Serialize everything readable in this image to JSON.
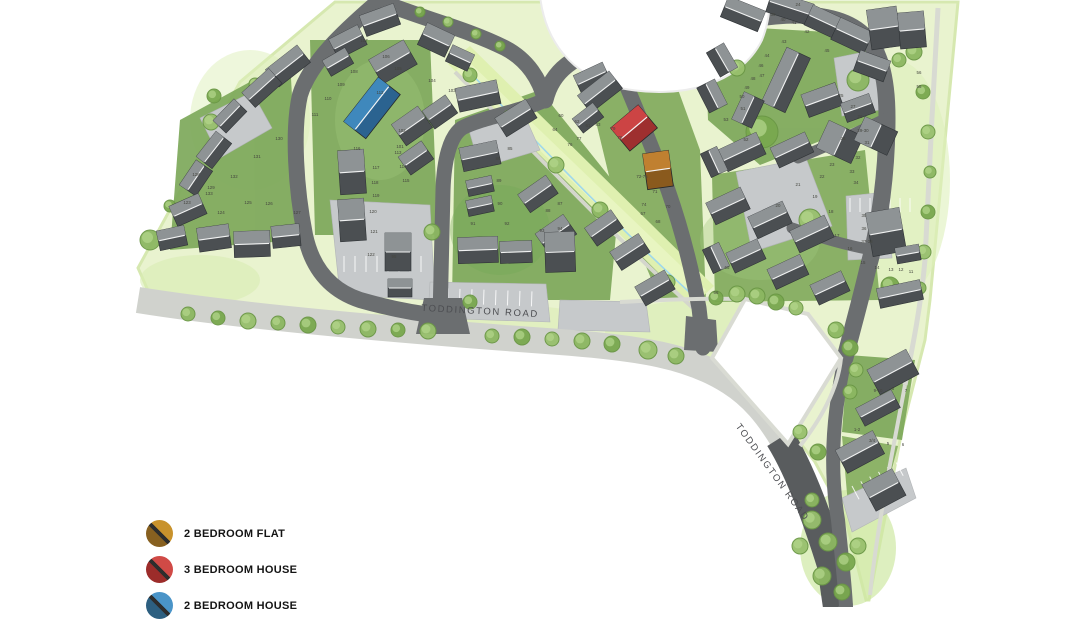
{
  "map": {
    "description": "Housing development site plan, watercolour style",
    "road_labels": [
      {
        "text": "TODDINGTON ROAD",
        "x": 480,
        "y": 314,
        "rotate": 3
      },
      {
        "text": "TODDINGTON ROAD",
        "x": 770,
        "y": 474,
        "rotate": 54
      }
    ],
    "colors": {
      "road_dark": "#6b6e70",
      "road_existing": "#d0d2cd",
      "garden_green": "#7da85a",
      "open_space": "#e9f3cf",
      "house_roof_dark": "#4b4f52",
      "house_roof_light": "#969a9c",
      "stream_blue": "#9fd8ec"
    },
    "highlighted_units": [
      {
        "type": "2 BEDROOM FLAT",
        "plots": "72-75",
        "color": "#c08030",
        "dark": "#8a5a1d",
        "x": 658,
        "y": 170,
        "w": 26,
        "h": 36,
        "rotate": -8
      },
      {
        "type": "3 BEDROOM HOUSE",
        "plots": "76-79",
        "color": "#cc4444",
        "dark": "#9e2f2f",
        "x": 634,
        "y": 128,
        "w": 36,
        "h": 30,
        "rotate": -40
      },
      {
        "type": "2 BEDROOM HOUSE",
        "plots": "113-115",
        "color": "#3f88bc",
        "dark": "#2b6390",
        "x": 372,
        "y": 108,
        "w": 56,
        "h": 28,
        "rotate": -52
      }
    ],
    "plot_labels": [
      {
        "n": "123",
        "x": 187,
        "y": 204
      },
      {
        "n": "124",
        "x": 221,
        "y": 214
      },
      {
        "n": "125",
        "x": 248,
        "y": 204
      },
      {
        "n": "126",
        "x": 269,
        "y": 205
      },
      {
        "n": "127",
        "x": 297,
        "y": 214
      },
      {
        "n": "128",
        "x": 196,
        "y": 176
      },
      {
        "n": "129",
        "x": 211,
        "y": 189
      },
      {
        "n": "130",
        "x": 279,
        "y": 140
      },
      {
        "n": "131",
        "x": 257,
        "y": 158
      },
      {
        "n": "132",
        "x": 234,
        "y": 178
      },
      {
        "n": "133",
        "x": 209,
        "y": 195
      },
      {
        "n": "101",
        "x": 400,
        "y": 148
      },
      {
        "n": "102",
        "x": 402,
        "y": 132
      },
      {
        "n": "103",
        "x": 452,
        "y": 92
      },
      {
        "n": "104",
        "x": 432,
        "y": 82
      },
      {
        "n": "105",
        "x": 398,
        "y": 70
      },
      {
        "n": "106",
        "x": 386,
        "y": 58
      },
      {
        "n": "107",
        "x": 364,
        "y": 42
      },
      {
        "n": "108",
        "x": 354,
        "y": 73
      },
      {
        "n": "109",
        "x": 341,
        "y": 86
      },
      {
        "n": "110",
        "x": 328,
        "y": 100
      },
      {
        "n": "111",
        "x": 315,
        "y": 116
      },
      {
        "n": "112",
        "x": 380,
        "y": 94
      },
      {
        "n": "113",
        "x": 398,
        "y": 154
      },
      {
        "n": "114",
        "x": 403,
        "y": 168
      },
      {
        "n": "115",
        "x": 406,
        "y": 182
      },
      {
        "n": "116",
        "x": 357,
        "y": 150
      },
      {
        "n": "117",
        "x": 376,
        "y": 169
      },
      {
        "n": "118",
        "x": 375,
        "y": 184
      },
      {
        "n": "119",
        "x": 376,
        "y": 197
      },
      {
        "n": "120",
        "x": 373,
        "y": 213
      },
      {
        "n": "121",
        "x": 374,
        "y": 233
      },
      {
        "n": "122",
        "x": 371,
        "y": 256
      },
      {
        "n": "60",
        "x": 561,
        "y": 117
      },
      {
        "n": "61",
        "x": 588,
        "y": 127
      },
      {
        "n": "62",
        "x": 577,
        "y": 123
      },
      {
        "n": "63",
        "x": 598,
        "y": 126
      },
      {
        "n": "64",
        "x": 555,
        "y": 131
      },
      {
        "n": "67",
        "x": 643,
        "y": 215
      },
      {
        "n": "68",
        "x": 658,
        "y": 223
      },
      {
        "n": "70",
        "x": 668,
        "y": 208
      },
      {
        "n": "71",
        "x": 655,
        "y": 193
      },
      {
        "n": "72-75",
        "x": 642,
        "y": 178
      },
      {
        "n": "74",
        "x": 644,
        "y": 206
      },
      {
        "n": "76",
        "x": 570,
        "y": 146
      },
      {
        "n": "77",
        "x": 579,
        "y": 140
      },
      {
        "n": "78",
        "x": 620,
        "y": 139
      },
      {
        "n": "79",
        "x": 613,
        "y": 130
      },
      {
        "n": "85",
        "x": 510,
        "y": 150
      },
      {
        "n": "86",
        "x": 498,
        "y": 160
      },
      {
        "n": "87",
        "x": 560,
        "y": 205
      },
      {
        "n": "88",
        "x": 548,
        "y": 212
      },
      {
        "n": "89",
        "x": 499,
        "y": 182
      },
      {
        "n": "90",
        "x": 500,
        "y": 205
      },
      {
        "n": "91",
        "x": 473,
        "y": 225
      },
      {
        "n": "92",
        "x": 507,
        "y": 225
      },
      {
        "n": "93",
        "x": 542,
        "y": 232
      },
      {
        "n": "94",
        "x": 560,
        "y": 230
      },
      {
        "n": "95",
        "x": 394,
        "y": 258
      },
      {
        "n": "11",
        "x": 911,
        "y": 273
      },
      {
        "n": "12",
        "x": 901,
        "y": 271
      },
      {
        "n": "13",
        "x": 891,
        "y": 271
      },
      {
        "n": "14",
        "x": 877,
        "y": 269
      },
      {
        "n": "15",
        "x": 863,
        "y": 264
      },
      {
        "n": "16",
        "x": 850,
        "y": 250
      },
      {
        "n": "17",
        "x": 837,
        "y": 237
      },
      {
        "n": "18",
        "x": 831,
        "y": 213
      },
      {
        "n": "19",
        "x": 815,
        "y": 198
      },
      {
        "n": "20",
        "x": 778,
        "y": 207
      },
      {
        "n": "21",
        "x": 798,
        "y": 186
      },
      {
        "n": "22",
        "x": 822,
        "y": 178
      },
      {
        "n": "23",
        "x": 832,
        "y": 166
      },
      {
        "n": "24",
        "x": 798,
        "y": 6
      },
      {
        "n": "25",
        "x": 841,
        "y": 97
      },
      {
        "n": "26",
        "x": 843,
        "y": 140
      },
      {
        "n": "27",
        "x": 853,
        "y": 108
      },
      {
        "n": "28",
        "x": 860,
        "y": 118
      },
      {
        "n": "29-30",
        "x": 863,
        "y": 132
      },
      {
        "n": "31",
        "x": 867,
        "y": 144
      },
      {
        "n": "32",
        "x": 858,
        "y": 159
      },
      {
        "n": "33",
        "x": 852,
        "y": 173
      },
      {
        "n": "34",
        "x": 856,
        "y": 184
      },
      {
        "n": "35",
        "x": 864,
        "y": 217
      },
      {
        "n": "36",
        "x": 864,
        "y": 230
      },
      {
        "n": "37-38",
        "x": 867,
        "y": 243
      },
      {
        "n": "39",
        "x": 773,
        "y": 16
      },
      {
        "n": "40",
        "x": 783,
        "y": 21
      },
      {
        "n": "41",
        "x": 794,
        "y": 24
      },
      {
        "n": "42",
        "x": 807,
        "y": 33
      },
      {
        "n": "43",
        "x": 784,
        "y": 43
      },
      {
        "n": "44",
        "x": 767,
        "y": 57
      },
      {
        "n": "45",
        "x": 827,
        "y": 52
      },
      {
        "n": "46",
        "x": 761,
        "y": 67
      },
      {
        "n": "47",
        "x": 762,
        "y": 77
      },
      {
        "n": "48",
        "x": 753,
        "y": 80
      },
      {
        "n": "49",
        "x": 747,
        "y": 89
      },
      {
        "n": "50",
        "x": 742,
        "y": 98
      },
      {
        "n": "51",
        "x": 743,
        "y": 110
      },
      {
        "n": "52",
        "x": 746,
        "y": 141
      },
      {
        "n": "53",
        "x": 726,
        "y": 121
      },
      {
        "n": "55",
        "x": 919,
        "y": 88
      },
      {
        "n": "56",
        "x": 919,
        "y": 74
      },
      {
        "n": "65",
        "x": 727,
        "y": 269
      },
      {
        "n": "66",
        "x": 716,
        "y": 294
      },
      {
        "n": "1-2",
        "x": 857,
        "y": 431
      },
      {
        "n": "3/4",
        "x": 872,
        "y": 442
      },
      {
        "n": "5",
        "x": 888,
        "y": 445
      },
      {
        "n": "6",
        "x": 903,
        "y": 446
      },
      {
        "n": "7",
        "x": 906,
        "y": 392
      },
      {
        "n": "8",
        "x": 893,
        "y": 390
      },
      {
        "n": "9-10",
        "x": 878,
        "y": 392
      }
    ]
  },
  "legend": {
    "items": [
      {
        "label": "2 BEDROOM FLAT",
        "color": "#c8922c",
        "color_dark": "#876020"
      },
      {
        "label": "3 BEDROOM HOUSE",
        "color": "#d04a46",
        "color_dark": "#9c2c2a"
      },
      {
        "label": "2 BEDROOM HOUSE",
        "color": "#4a94c8",
        "color_dark": "#2d5f80"
      }
    ]
  }
}
